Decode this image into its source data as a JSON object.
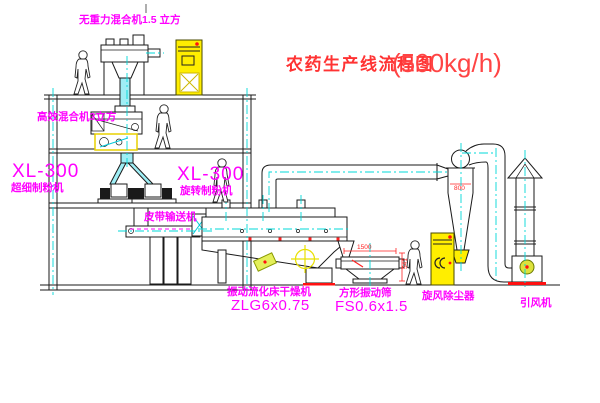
{
  "title": {
    "text": "农药生产线流程图",
    "capacity": "(500kg/h)"
  },
  "labels": {
    "mixer_top": "无重力混合机1.5 立方",
    "mixer_2f": "高效混合机3立方",
    "mill_left_model": "XL-300",
    "mill_left": "超细制粉机",
    "mill_right_model": "XL-300",
    "mill_right": "旋转制粉机",
    "belt": "皮带输送机",
    "dryer": "振动流化床干燥机",
    "dryer_model": "ZLG6x0.75",
    "sieve": "方形振动筛",
    "sieve_model": "FS0.6x1.5",
    "cyclone": "旋风除尘器",
    "fan": "引风机"
  },
  "dimensions": {
    "sieve_width": "1500",
    "sieve_height": "541",
    "cyclone_dia": "800"
  },
  "colors": {
    "line": "#1a1a1a",
    "centerline": "#00d8d8",
    "label": "#ff00ff",
    "title": "#ff3333",
    "cabinet": "#ffee00",
    "pipe_fill": "#9feef5",
    "dimension": "#ff2222"
  }
}
